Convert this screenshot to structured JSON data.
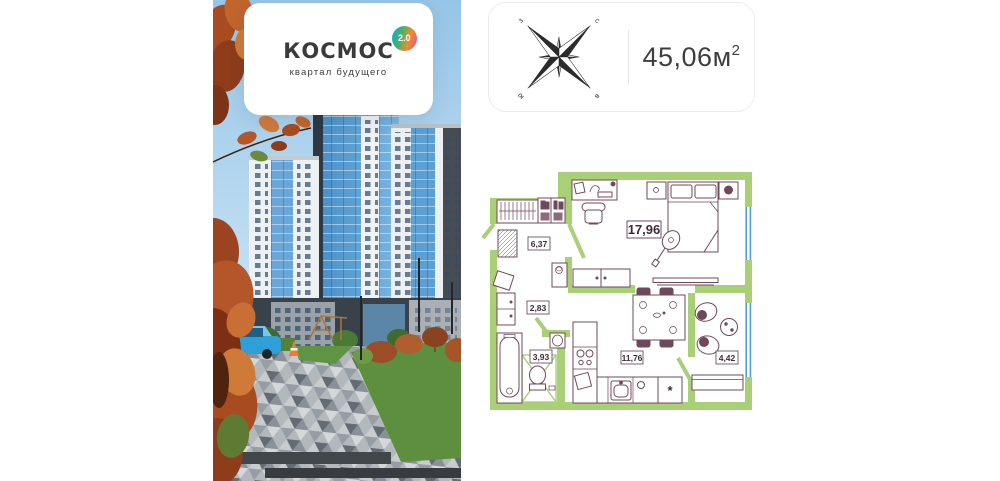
{
  "logo_card": {
    "title": "КОСМОС",
    "badge": "2.0",
    "subtitle": "квартал будущего"
  },
  "info_card": {
    "area_value": "45,06м",
    "area_sup": "2",
    "compass": {
      "north": "с",
      "south": "ю",
      "west": "з",
      "east": "в"
    }
  },
  "floor_plan": {
    "labels": {
      "living": "17,96",
      "hallway": "6,37",
      "corridor": "2,83",
      "bathroom": "3,93",
      "kitchen": "11,76",
      "balcony": "4,42"
    },
    "fridge_marker": "*",
    "colors": {
      "wall": "#a9cf77",
      "furniture": "#6f4859",
      "window": "#4f9fd9"
    }
  }
}
